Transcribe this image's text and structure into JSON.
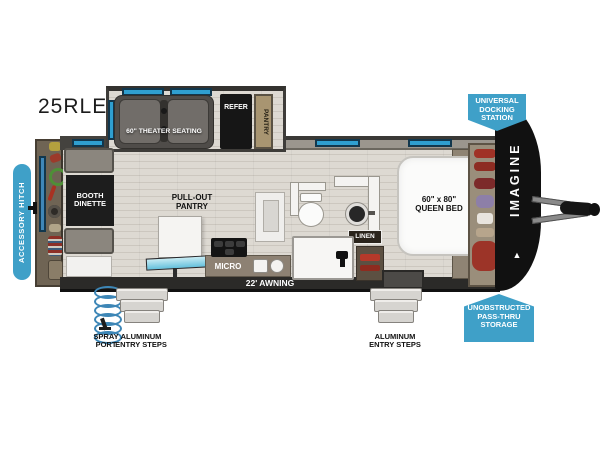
{
  "title": "25RLE",
  "colors": {
    "callout_blue": "#3fa0c8",
    "window_teal": "#2f9fd0",
    "wall_dark": "#44423e",
    "counter_brown": "#8d8173",
    "front_cap_black": "#111111"
  },
  "slideout": {
    "theater_seating": "60\" THEATER SEATING",
    "refer": "REFER",
    "pantry": "PANTRY"
  },
  "dinette": {
    "label": "BOOTH\nDINETTE"
  },
  "kitchen": {
    "pull_out_pantry": "PULL-OUT\nPANTRY",
    "micro": "MICRO"
  },
  "bathroom": {
    "linen": "LINEN"
  },
  "bedroom": {
    "bed": "60\" x 80\"\nQUEEN BED"
  },
  "exterior": {
    "brand": "IMAGINE",
    "awning": "22' AWNING",
    "spray_port": "SPRAY\nPORT",
    "entry_steps_left": "ALUMINUM\nENTRY STEPS",
    "entry_steps_right": "ALUMINUM\nENTRY STEPS"
  },
  "callouts": {
    "universal_docking_station": "UNIVERSAL\nDOCKING\nSTATION",
    "accessory_hitch": "ACCESSORY HITCH",
    "pass_thru_storage": "UNOBSTRUCTED\nPASS-THRU\nSTORAGE"
  }
}
